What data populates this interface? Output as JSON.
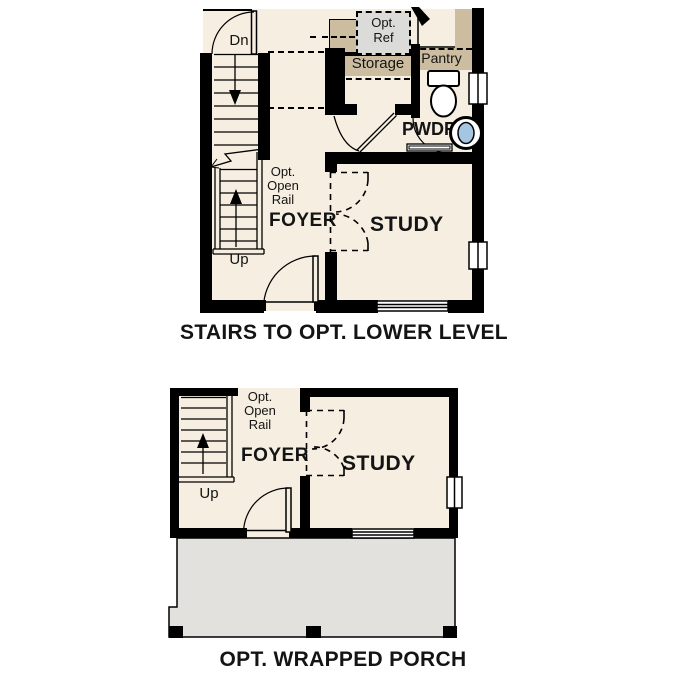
{
  "colors": {
    "floor": "#F5EEE1",
    "tan": "#CCBDA1",
    "fridge": "#DBDBDA",
    "porch": "#E2E1DD",
    "wall": "#000000",
    "sink_blue": "#A5C6E3"
  },
  "upper_plan": {
    "caption": "STAIRS TO OPT. LOWER LEVEL",
    "labels": {
      "dn": "Dn",
      "up": "Up",
      "opt_ref_1": "Opt.",
      "opt_ref_2": "Ref",
      "storage": "Storage",
      "pantry": "Pantry",
      "pwdr": "PWDR",
      "rail_1": "Opt.",
      "rail_2": "Open",
      "rail_3": "Rail",
      "foyer": "FOYER",
      "study": "STUDY"
    }
  },
  "lower_plan": {
    "caption": "OPT. WRAPPED PORCH",
    "labels": {
      "up": "Up",
      "rail_1": "Opt.",
      "rail_2": "Open",
      "rail_3": "Rail",
      "foyer": "FOYER",
      "study": "STUDY"
    }
  }
}
